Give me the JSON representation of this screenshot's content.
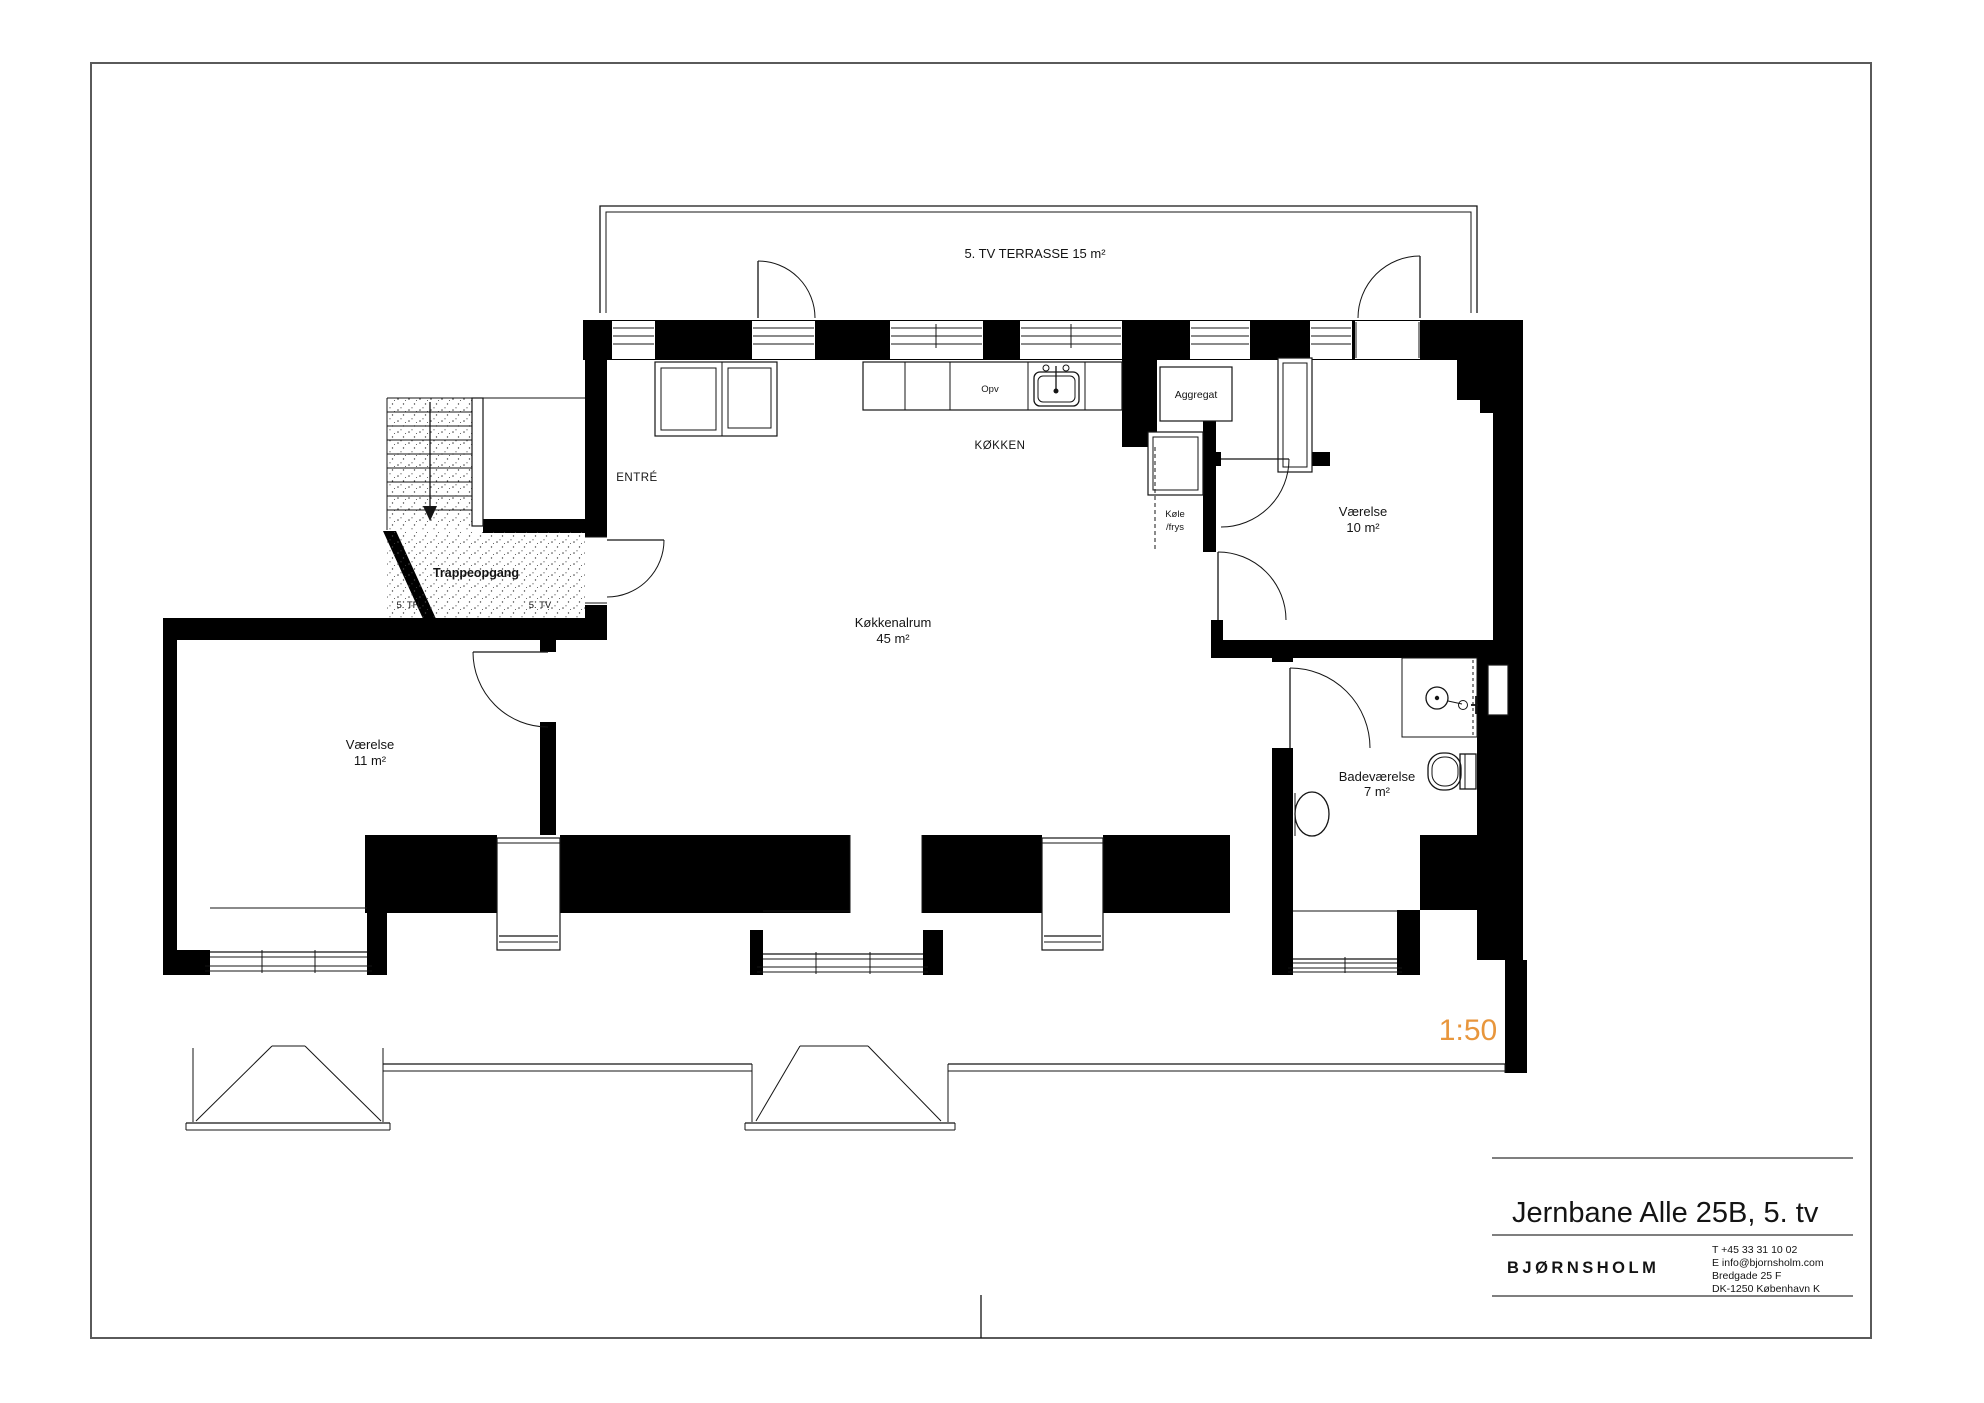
{
  "page": {
    "frame_color": "#5a5a5a",
    "background": "#ffffff"
  },
  "plan": {
    "terrace": {
      "label": "5. TV TERRASSE 15 m²"
    },
    "entre": {
      "label": "ENTRÉ"
    },
    "kitchen": {
      "label": "KØKKEN",
      "dishwasher": "Opv"
    },
    "units": {
      "aggregat": "Aggregat",
      "fridge_line1": "Køle",
      "fridge_line2": "/frys"
    },
    "stairwell": {
      "label": "Trappeopgang",
      "door_left": "5. TH",
      "door_right": "5. TV"
    },
    "rooms": {
      "bedroom_left": {
        "name": "Værelse",
        "area": "11 m²"
      },
      "bedroom_right": {
        "name": "Værelse",
        "area": "10 m²"
      },
      "kitchen_living": {
        "name": "Køkkenalrum",
        "area": "45 m²"
      },
      "bathroom": {
        "name": "Badeværelse",
        "area": "7 m²"
      }
    },
    "scale": {
      "label": "1:50",
      "color": "#E8963C"
    }
  },
  "title_block": {
    "title": "Jernbane Alle 25B, 5. tv",
    "company": "BJØRNSHOLM",
    "contact": {
      "phone": "T  +45 33 31 10 02",
      "email": "E  info@bjornsholm.com",
      "address1": "Bredgade 25 F",
      "address2": "DK-1250 København K"
    }
  }
}
